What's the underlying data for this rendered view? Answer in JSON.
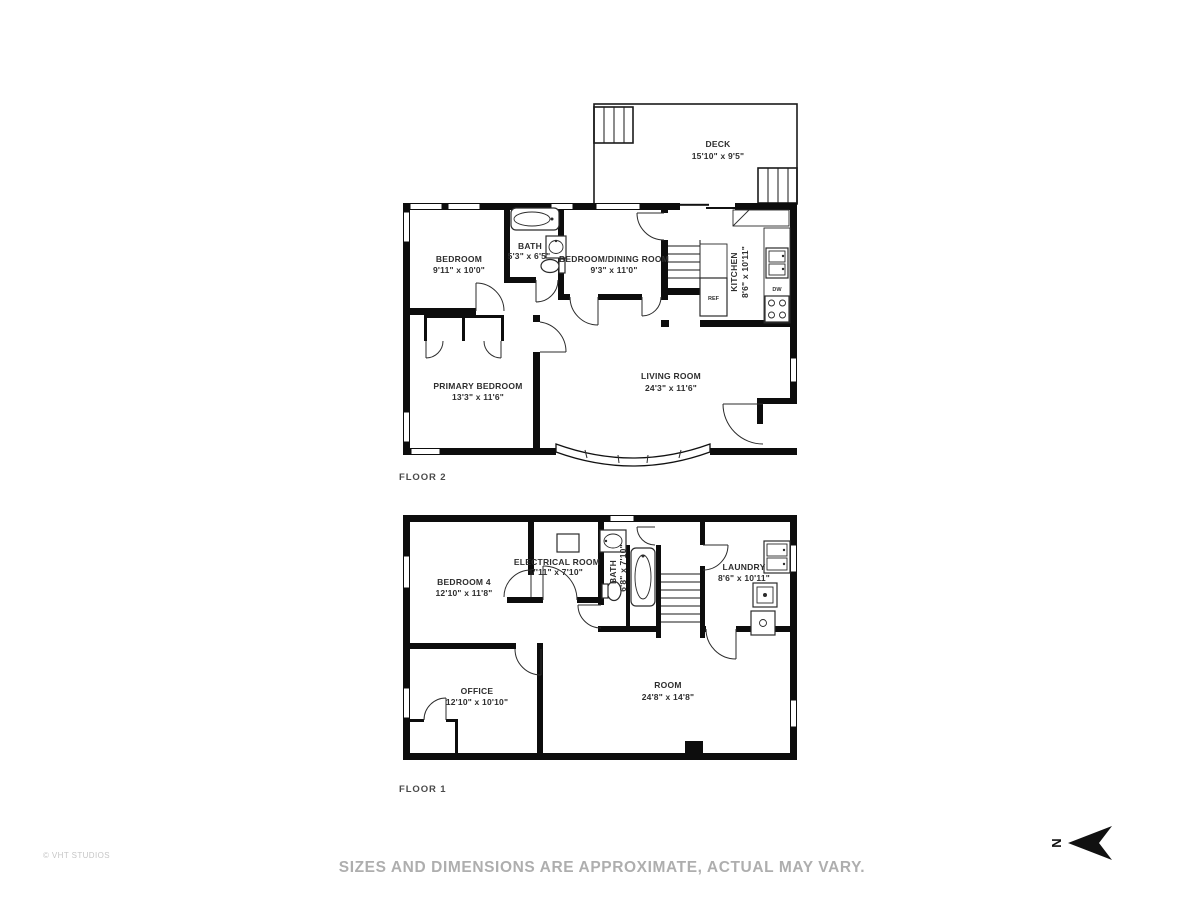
{
  "page": {
    "copyright": "© VHT STUDIOS",
    "disclaimer": "SIZES AND DIMENSIONS ARE APPROXIMATE, ACTUAL MAY VARY.",
    "north_label": "N"
  },
  "floor2": {
    "label": "FLOOR 2",
    "rooms": {
      "deck": {
        "name": "DECK",
        "dims": "15'10\" x 9'5\""
      },
      "bedroom": {
        "name": "BEDROOM",
        "dims": "9'11\" x 10'0\""
      },
      "bath": {
        "name": "BATH",
        "dims": "5'3\" x 6'5\""
      },
      "bedroom_dining": {
        "name": "BEDROOM/DINING ROOM",
        "dims": "9'3\" x 11'0\""
      },
      "kitchen": {
        "name": "KITCHEN",
        "dims": "8'6\" x 10'11\""
      },
      "primary_bedroom": {
        "name": "PRIMARY BEDROOM",
        "dims": "13'3\" x 11'6\""
      },
      "living_room": {
        "name": "LIVING ROOM",
        "dims": "24'3\" x 11'6\""
      }
    },
    "fixtures": {
      "ref": "REF",
      "dw": "DW"
    }
  },
  "floor1": {
    "label": "FLOOR 1",
    "rooms": {
      "bedroom4": {
        "name": "BEDROOM 4",
        "dims": "12'10\" x 11'8\""
      },
      "electrical": {
        "name": "ELECTRICAL ROOM",
        "dims": "7'11\" x 7'10\""
      },
      "bath": {
        "name": "BATH",
        "dims": "6'8\" x 7'10\""
      },
      "laundry": {
        "name": "LAUNDRY",
        "dims": "8'6\" x 10'11\""
      },
      "office": {
        "name": "OFFICE",
        "dims": "12'10\" x 10'10\""
      },
      "room": {
        "name": "ROOM",
        "dims": "24'8\" x 14'8\""
      }
    }
  }
}
